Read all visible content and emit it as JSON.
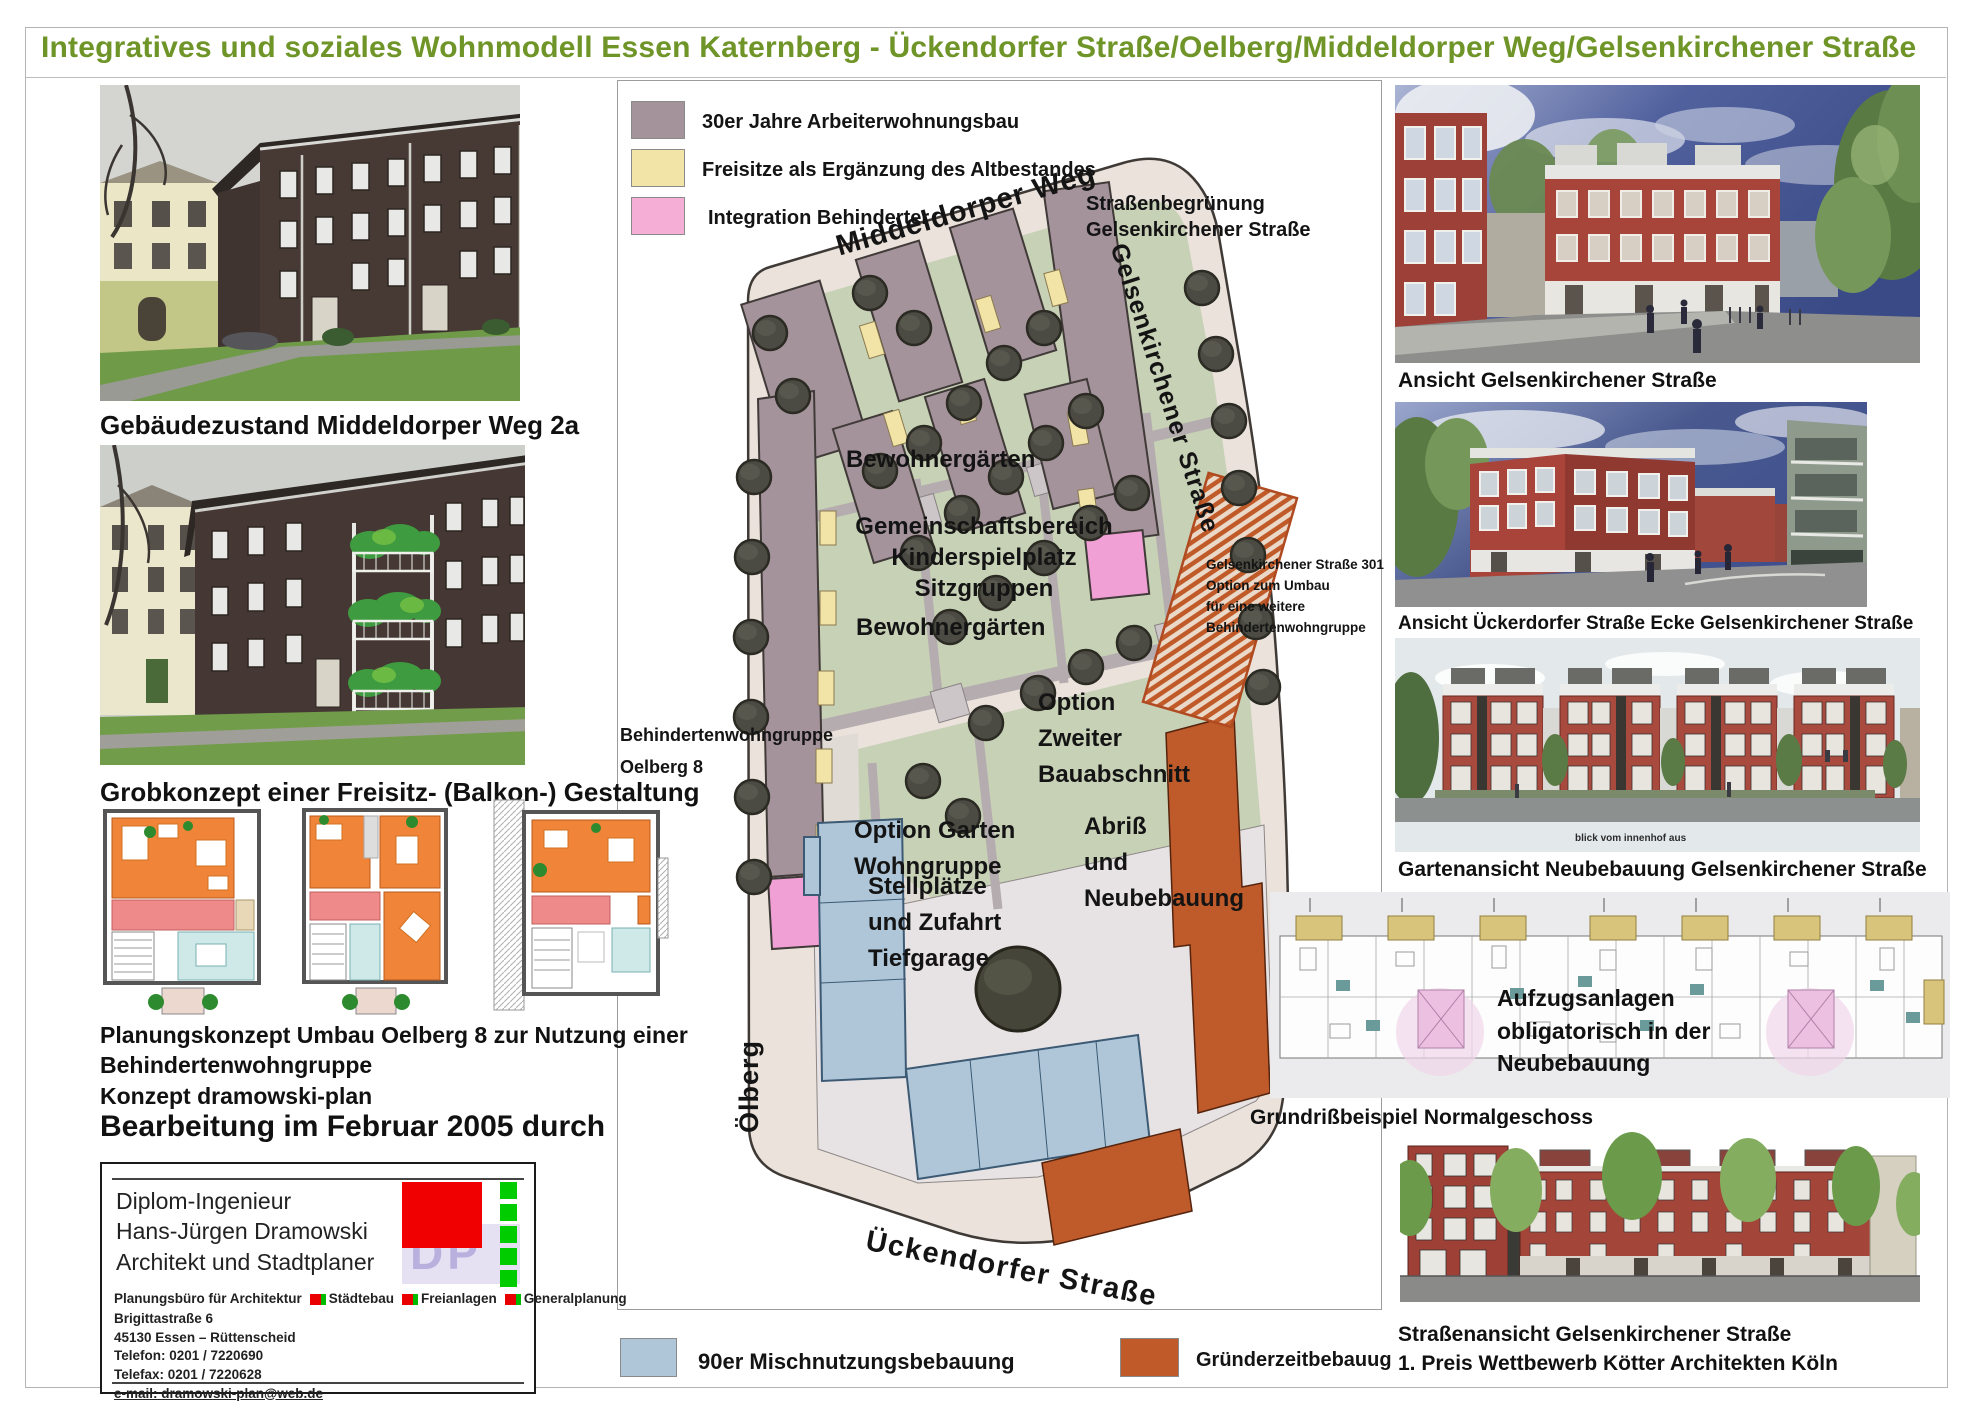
{
  "page": {
    "title": "Integratives und soziales Wohnmodell Essen Katernberg - Ückendorfer Straße/Oelberg/Middeldorper Weg/Gelsenkirchener Straße",
    "title_color": "#6f9427"
  },
  "legend_top": {
    "items": [
      {
        "label": "30er Jahre Arbeiterwohnungsbau",
        "color": "#a5939b"
      },
      {
        "label": "Freisitze als Ergänzung des Altbestandes",
        "color": "#f2e3a6"
      },
      {
        "label": "Integration Behinderter",
        "color": "#f5aed6"
      }
    ]
  },
  "legend_bottom": {
    "items": [
      {
        "label": "90er Mischnutzungsbebauung",
        "color": "#aec6d8"
      },
      {
        "label": "Gründerzeitbebauug",
        "color": "#c05a28"
      }
    ]
  },
  "left_column": {
    "photo1_caption": "Gebäudezustand Middeldorper Weg 2a",
    "photo2_caption": "Grobkonzept einer Freisitz- (Balkon-) Gestaltung",
    "planning": {
      "line1": "Planungskonzept Umbau Oelberg 8 zur Nutzung einer",
      "line2": "Behindertenwohngruppe",
      "line3": "Konzept dramowski-plan"
    },
    "edit_note": "Bearbeitung im Februar 2005 durch",
    "infobox": {
      "name1": "Diplom-Ingenieur",
      "name2": "Hans-Jürgen Dramowski",
      "name3": "Architekt und Stadtplaner",
      "logo_letters": "DP",
      "services": {
        "s1": "Planungsbüro für Architektur",
        "s2": "Städtebau",
        "s3": "Freianlagen",
        "s4": "Generalplanung"
      },
      "address1": "Brigittastraße 6",
      "address2": "45130 Essen – Rüttenscheid",
      "phone": "Telefon: 0201 / 7220690",
      "fax": "Telefax: 0201 / 7220628",
      "email": "e-mail: dramowski-plan@web.de"
    }
  },
  "site_plan": {
    "streets": {
      "top": "Middeldorper Weg",
      "right": "Gelsenkirchener Straße",
      "left": "Ölberg",
      "bottom": "Ückendorfer Straße"
    },
    "labels": {
      "greening1": "Straßenbegrünung",
      "greening2": "Gelsenkirchener Straße",
      "gardens1": "Bewohnergärten",
      "community1": "Gemeinschaftsbereich",
      "community2": "Kinderspielplatz",
      "community3": "Sitzgruppen",
      "gardens2": "Bewohnergärten",
      "note301_1": "Gelsenkirchener Straße 301",
      "note301_2": "Option zum Umbau",
      "note301_3": "für eine weitere",
      "note301_4": "Behindertenwohngruppe",
      "group1": "Behindertenwohngruppe",
      "group2": "Oelberg 8",
      "garten1": "Option Garten",
      "garten2": "Wohngruppe",
      "zweiter1": "Option",
      "zweiter2": "Zweiter",
      "zweiter3": "Bauabschnitt",
      "stell1": "Stellplätze",
      "stell2": "und Zufahrt",
      "stell3": "Tiefgarage",
      "abriss1": "Abriß",
      "abriss2": "und",
      "abriss3": "Neubebauung"
    }
  },
  "right_column": {
    "caption1": "Ansicht Gelsenkirchener Straße",
    "caption2": "Ansicht Ückerdorfer Straße Ecke Gelsenkirchener Straße",
    "caption3": "Gartenansicht Neubebauung Gelsenkirchener Straße",
    "garden_note": "blick vom innenhof aus",
    "lift_note1": "Aufzugsanlagen",
    "lift_note2": "obligatorisch in der",
    "lift_note3": "Neubebauung",
    "caption4": "Grundrißbeispiel Normalgeschoss",
    "caption5a": "Straßenansicht Gelsenkirchener Straße",
    "caption5b": "1. Preis Wettbewerb Kötter Architekten Köln"
  }
}
